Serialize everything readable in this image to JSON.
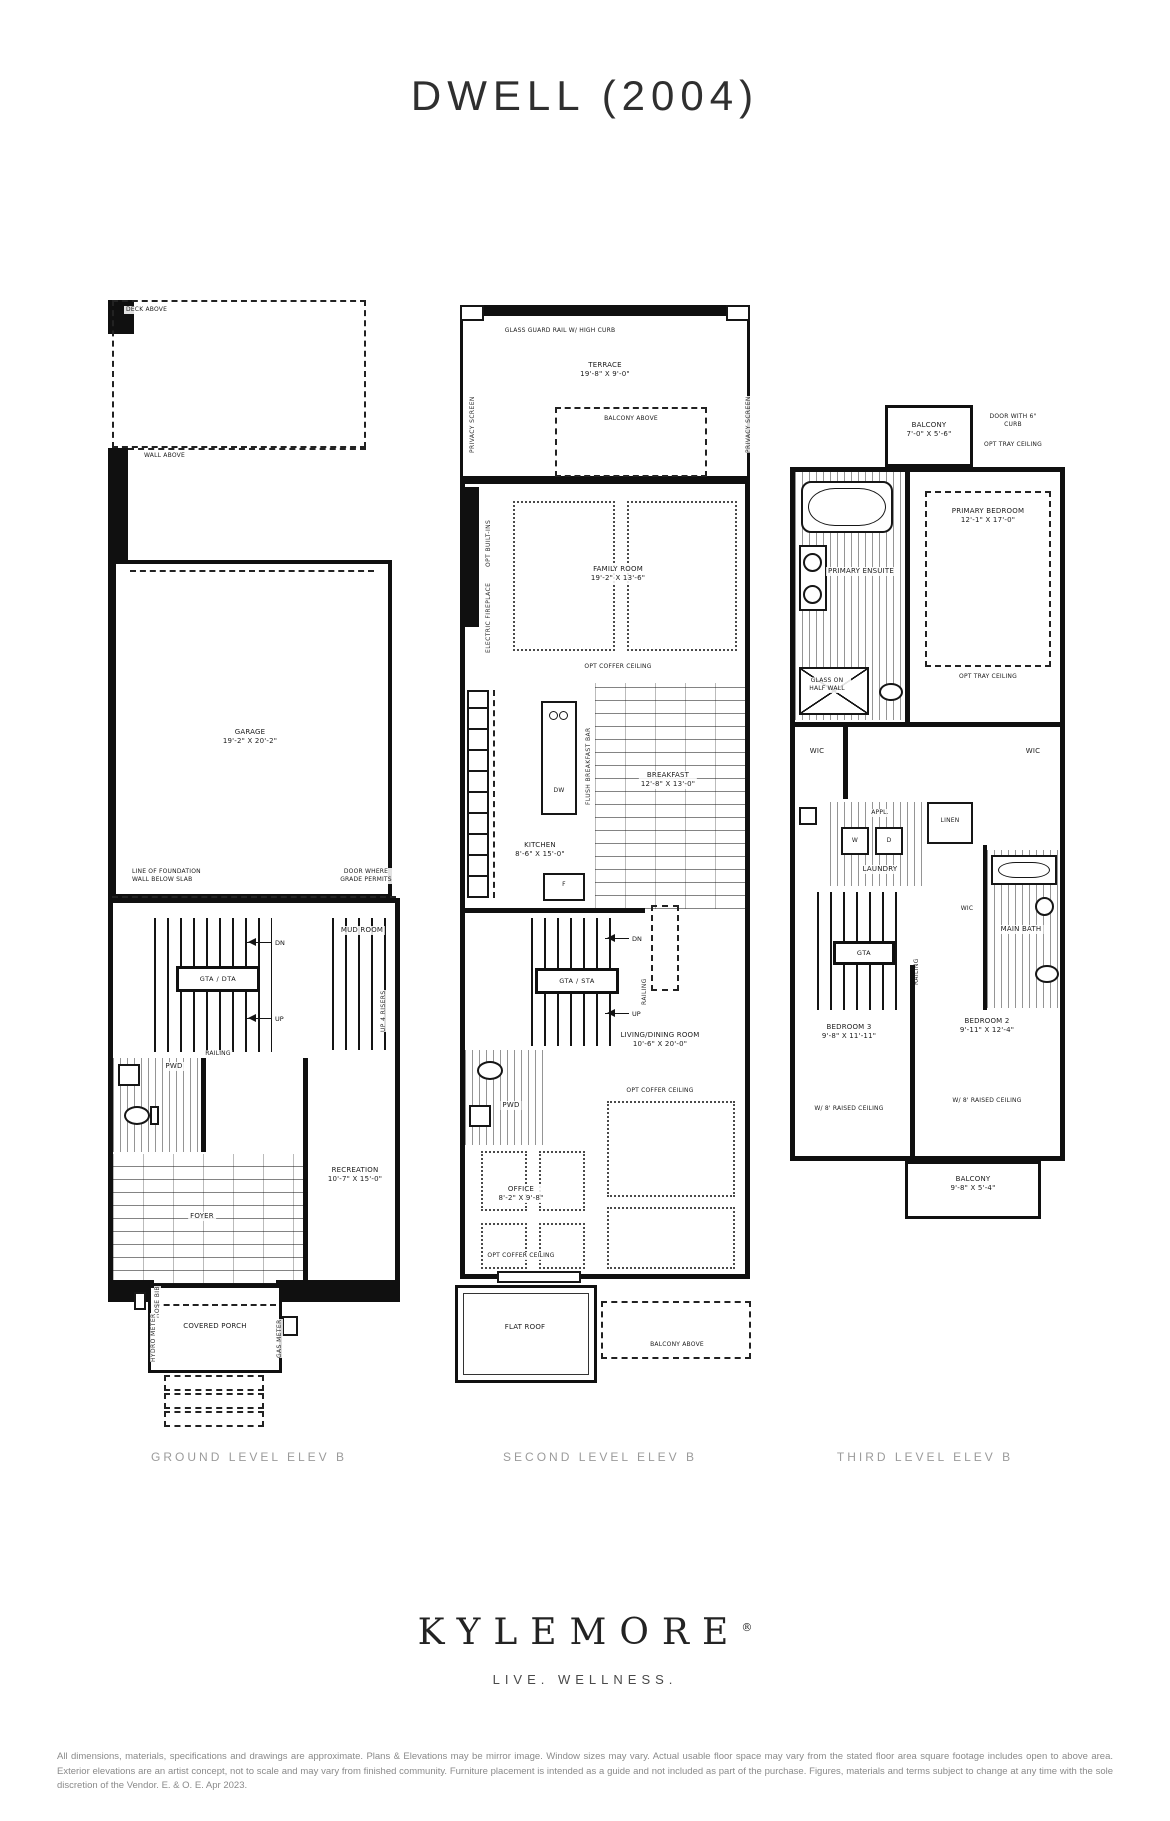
{
  "title": "DWELL (2004)",
  "plans": {
    "ground": {
      "caption": "GROUND LEVEL ELEV B",
      "deck_above": "DECK ABOVE",
      "wall_above": "WALL ABOVE",
      "garage_name": "GARAGE",
      "garage_dims": "19'-2\" X 20'-2\"",
      "foundation_note": "LINE OF FOUNDATION WALL BELOW SLAB",
      "door_grade": "DOOR WHERE GRADE PERMITS",
      "stair_label": "GTA / DTA",
      "dn": "DN",
      "up": "UP",
      "railing": "RAILING",
      "mud_room": "MUD ROOM",
      "up_risers": "UP 4 RISERS",
      "pwd": "PWD",
      "recreation_name": "RECREATION",
      "recreation_dims": "10'-7\" X 15'-0\"",
      "foyer": "FOYER",
      "covered_porch": "COVERED PORCH",
      "hose_bib": "HOSE BIB",
      "hydro_meter": "HYDRO METER",
      "gas_meter": "GAS METER"
    },
    "second": {
      "caption": "SECOND LEVEL ELEV B",
      "glass_guard": "GLASS GUARD RAIL W/ HIGH CURB",
      "terrace_name": "TERRACE",
      "terrace_dims": "19'-8\" X 9'-0\"",
      "balcony_above": "BALCONY ABOVE",
      "privacy_screen": "PRIVACY SCREEN",
      "opt_builtins": "OPT BUILT-INS",
      "electric_fireplace": "ELECTRIC FIREPLACE",
      "family_name": "FAMILY ROOM",
      "family_dims": "19'-2\" X 13'-6\"",
      "opt_coffer": "OPT COFFER CEILING",
      "breakfast_name": "BREAKFAST",
      "breakfast_dims": "12'-8\" X 13'-0\"",
      "kitchen_name": "KITCHEN",
      "kitchen_dims": "8'-6\" X 15'-0\"",
      "dw": "DW",
      "fridge": "F",
      "flush_bar": "FLUSH BREAKFAST BAR",
      "stair_label": "GTA / STA",
      "dn": "DN",
      "up": "UP",
      "railing": "RAILING",
      "pwd": "PWD",
      "living_name": "LIVING/DINING ROOM",
      "living_dims": "10'-6\" X 20'-0\"",
      "office_name": "OFFICE",
      "office_dims": "8'-2\" X 9'-8\"",
      "flat_roof": "FLAT ROOF"
    },
    "third": {
      "caption": "THIRD LEVEL ELEV B",
      "balcony_name": "BALCONY",
      "balcony_top_dims": "7'-0\" X 5'-6\"",
      "door_curb": "DOOR WITH 6\" CURB",
      "opt_tray": "OPT TRAY CEILING",
      "primary_bed_name": "PRIMARY BEDROOM",
      "primary_bed_dims": "12'-1\" X 17'-0\"",
      "ensuite_name": "PRIMARY ENSUITE",
      "glass_half_wall": "GLASS ON HALF WALL",
      "wic": "WIC",
      "linen": "LINEN",
      "laundry": "LAUNDRY",
      "appl": "APPL.",
      "w": "W",
      "d": "D",
      "main_bath": "MAIN BATH",
      "stair_label": "GTA",
      "railing": "RAILING",
      "bed3_name": "BEDROOM 3",
      "bed3_dims": "9'-8\" X 11'-11\"",
      "bed2_name": "BEDROOM 2",
      "bed2_dims": "9'-11\" X 12'-4\"",
      "raised_ceiling": "W/ 8' RAISED CEILING",
      "balcony_bottom_dims": "9'-8\" X 5'-4\""
    }
  },
  "brand": {
    "logo": "KYLEMORE",
    "reg": "®",
    "tagline": "LIVE. WELLNESS."
  },
  "disclaimer": "All dimensions, materials, specifications and drawings are approximate. Plans & Elevations may be mirror image. Window sizes may vary. Actual usable floor space may vary from the stated floor area square footage includes open to above area. Exterior elevations are an artist concept, not to scale and may vary from finished community. Furniture placement is intended as a guide and not included as part of the purchase. Figures, materials and terms subject to change at any time with the sole discretion of the Vendor. E. & O. E. Apr 2023."
}
